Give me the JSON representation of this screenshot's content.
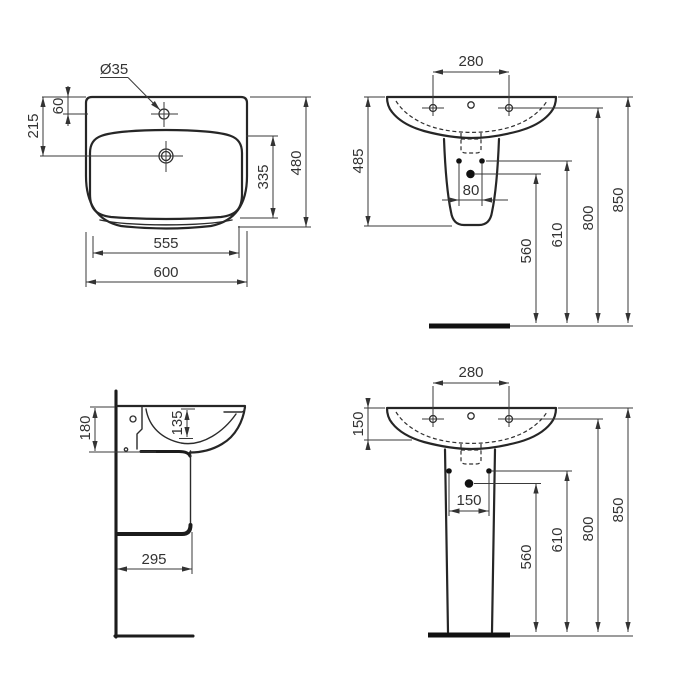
{
  "drawing": {
    "unit_note": "dimensions in mm (as printed on drawing)",
    "line_color": "#262626",
    "text_color": "#333333",
    "views": {
      "top": {
        "dims": {
          "tap_hole_dia": "Ø35",
          "edge_to_tap_hole": "60",
          "edge_to_drain": "215",
          "bowl_front": "335",
          "depth": "480",
          "bowl_width": "555",
          "width": "600"
        }
      },
      "front_semi": {
        "dims": {
          "tap_hole_spacing": "280",
          "height": "485",
          "fixing_spacing": "80",
          "h1": "560",
          "h2": "610",
          "h3": "800",
          "h4": "850"
        }
      },
      "side": {
        "dims": {
          "back_height": "180",
          "bowl_depth": "135",
          "wall_to_front": "295"
        }
      },
      "front_pedestal": {
        "dims": {
          "tap_hole_spacing": "280",
          "rim_height": "150",
          "fixing_spacing": "150",
          "h1": "560",
          "h2": "610",
          "h3": "800",
          "h4": "850"
        }
      }
    }
  }
}
